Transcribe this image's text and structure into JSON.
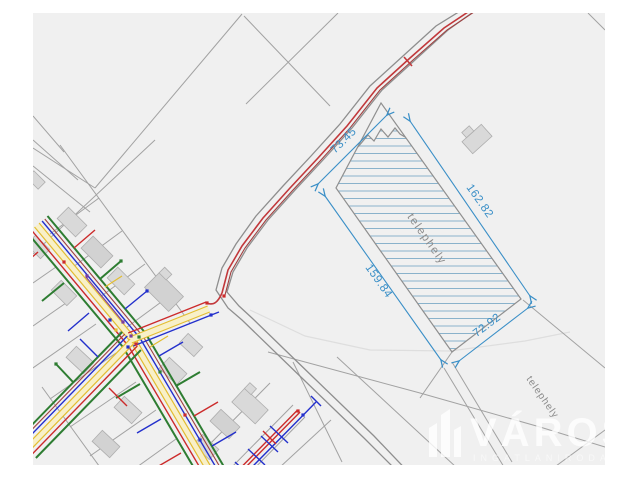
{
  "map": {
    "parcel": {
      "label": "telephely",
      "dimensions": {
        "northwest": "73.45",
        "northeast": "162.82",
        "southwest": "159.84",
        "southeast": "72.92"
      }
    },
    "neighbor_label": "telephely",
    "watermark": {
      "title": "VÁROSI",
      "subtitle": "INGATLANIRODA"
    }
  },
  "colors": {
    "page_background": "#ffffff",
    "map_background": "#f0f0f0",
    "parcel_line": "#a2a2a2",
    "road_line": "#8e8e8e",
    "faint_line": "#dedede",
    "building_fill": "#d9d9d9",
    "building_stroke": "#aeaeae",
    "dimension_blue": "#3a8fc7",
    "hatch_blue": "#8ab2cb",
    "label_gray": "#8c8c8c",
    "road_red": "#c2383b",
    "utility_red": "#cc2b2b",
    "utility_dark_red": "#a04040",
    "utility_blue": "#2330cc",
    "utility_green": "#2e7d32",
    "utility_yellow": "#e3bd30",
    "utility_yellow_fill": "#f8f0c8",
    "utility_purple": "#7b3fa0"
  }
}
